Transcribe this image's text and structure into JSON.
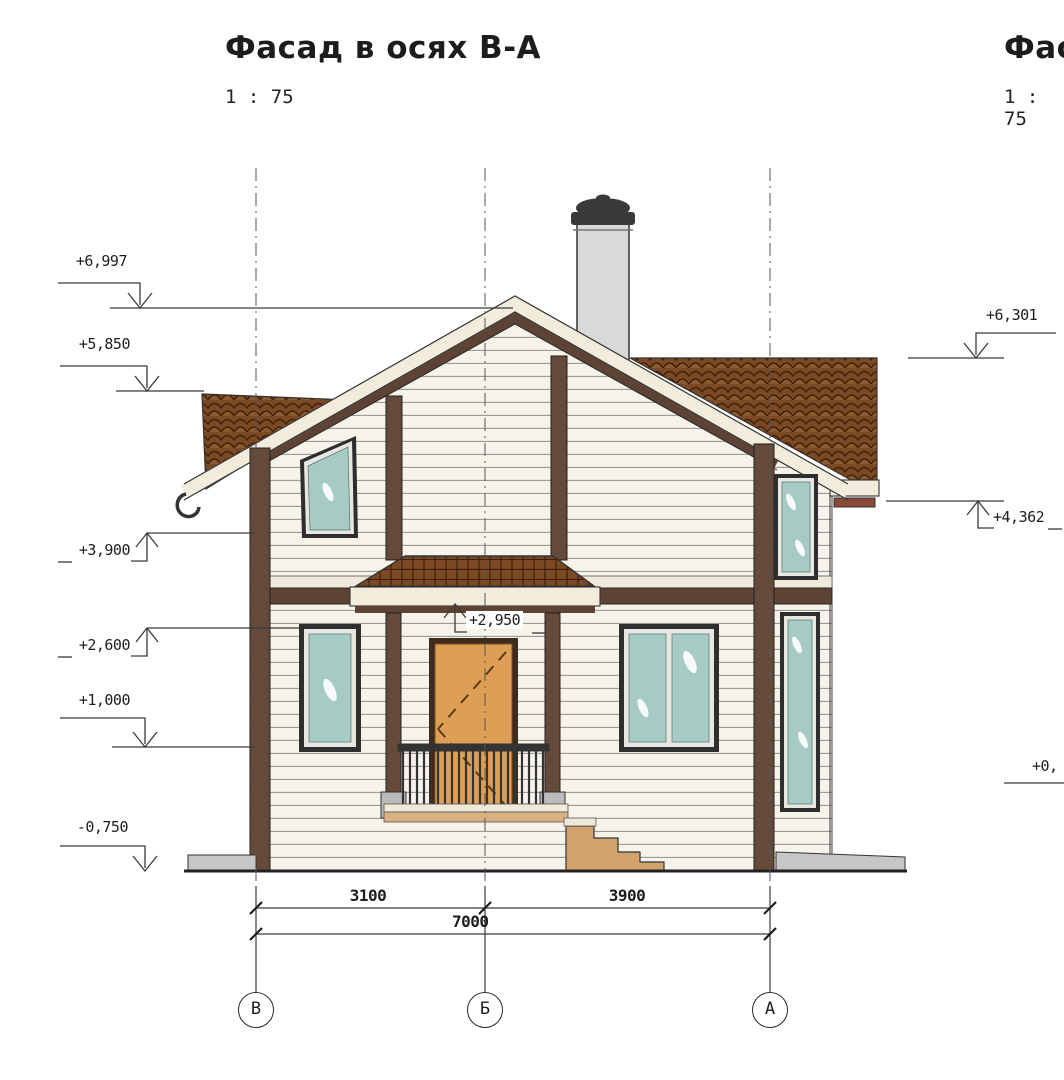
{
  "document": {
    "main_view": {
      "title": "Фасад в осях В-А",
      "scale": "1 : 75"
    },
    "adjacent_view": {
      "title_partial": "Фас",
      "scale": "1 : 75"
    }
  },
  "elevations": {
    "left": [
      "+6,997",
      "+5,850",
      "+3,900",
      "+2,600",
      "+1,000",
      "-0,750"
    ],
    "right": [
      "+6,301",
      "+4,362",
      "+0,"
    ],
    "canopy": "+2,950"
  },
  "dimensions": {
    "axis_spans": [
      "3100",
      "3900"
    ],
    "total": "7000"
  },
  "axes": [
    "В",
    "Б",
    "А"
  ],
  "colors": {
    "roof_tile": "#7b4a24",
    "tile_line": "#421f08",
    "timber": "#654a39",
    "bargeboard": "#5d4334",
    "siding": "#f6f3eb",
    "fascia": "#f2ecdc",
    "glass": "#a5cbc4",
    "door": "#dc9f55",
    "chimney": "#d9d9d9",
    "stairs": "#d2a46c",
    "concrete": "#c6c6c6",
    "gutter": "#8a4a38",
    "line": "#3a3a3a"
  }
}
